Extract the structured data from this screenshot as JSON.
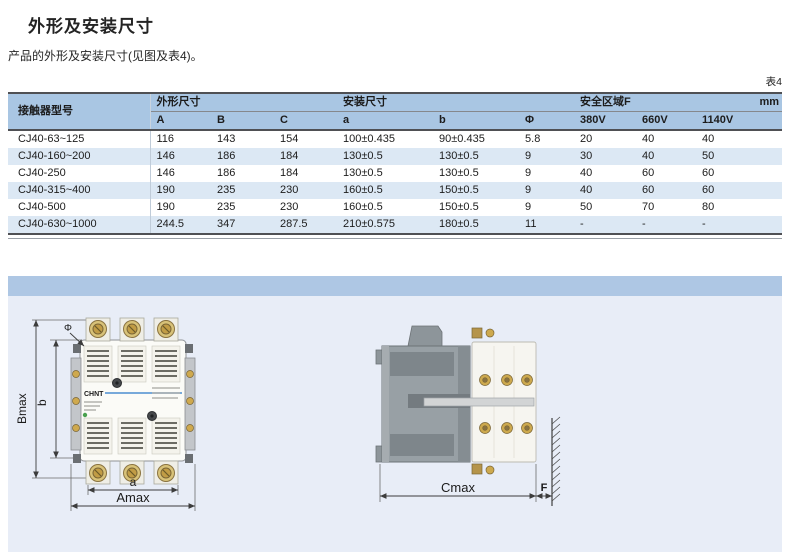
{
  "page": {
    "title": "外形及安装尺寸",
    "subtitle": "产品的外形及安装尺寸(见图及表4)。",
    "table_tag": "表4"
  },
  "table": {
    "header": {
      "model": "接触器型号",
      "outline_group": "外形尺寸",
      "mount_group": "安装尺寸",
      "safe_group": "安全区域F",
      "unit": "mm",
      "cols": [
        "A",
        "B",
        "C",
        "a",
        "b",
        "Φ",
        "380V",
        "660V",
        "1140V"
      ]
    },
    "rows": [
      [
        "CJ40-63~125",
        "116",
        "143",
        "154",
        "100±0.435",
        "90±0.435",
        "5.8",
        "20",
        "40",
        "40"
      ],
      [
        "CJ40-160~200",
        "146",
        "186",
        "184",
        "130±0.5",
        "130±0.5",
        "9",
        "30",
        "40",
        "50"
      ],
      [
        "CJ40-250",
        "146",
        "186",
        "184",
        "130±0.5",
        "130±0.5",
        "9",
        "40",
        "60",
        "60"
      ],
      [
        "CJ40-315~400",
        "190",
        "235",
        "230",
        "160±0.5",
        "150±0.5",
        "9",
        "40",
        "60",
        "60"
      ],
      [
        "CJ40-500",
        "190",
        "235",
        "230",
        "160±0.5",
        "150±0.5",
        "9",
        "50",
        "70",
        "80"
      ],
      [
        "CJ40-630~1000",
        "244.5",
        "347",
        "287.5",
        "210±0.575",
        "180±0.5",
        "11",
        "-",
        "-",
        "-"
      ]
    ]
  },
  "diagram": {
    "brand": "CHNT",
    "front": {
      "bmax": "Bmax",
      "b": "b",
      "phi": "Φ",
      "a": "a",
      "amax": "Amax"
    },
    "side": {
      "cmax": "Cmax",
      "f": "F"
    }
  },
  "colors": {
    "header_blue": "#a9c6e3",
    "row_alt_blue": "#dce8f4",
    "band_blue": "#aec7e4",
    "panel_bg": "#e8edf7",
    "brand_blue": "#2878c8",
    "brass": "#cda94e"
  }
}
